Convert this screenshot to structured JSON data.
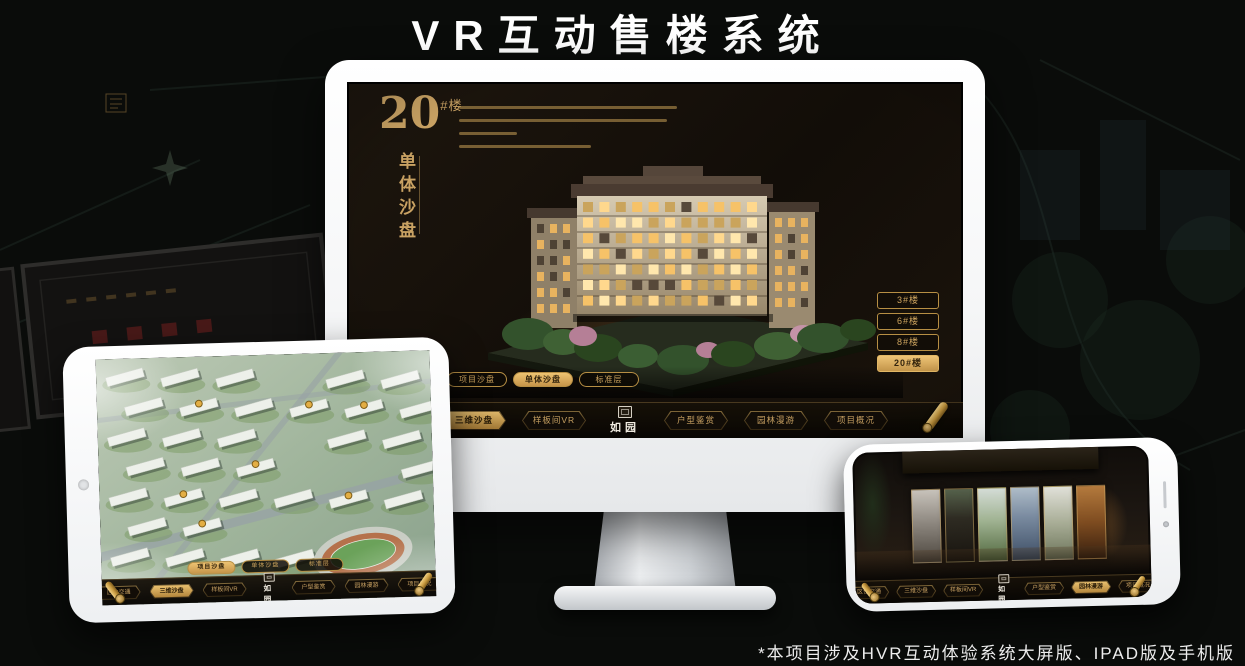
{
  "page": {
    "title": "VR互动售楼系统",
    "footer_note": "*本项目涉及HVR互动体验系统大屏版、IPAD版及手机版"
  },
  "colors": {
    "gold": "#c9a263",
    "gold_bright": "#e8bf6e",
    "screen_bg": "#17110c",
    "active_text": "#2a1d08",
    "monitor_frame": "#f5f6f7"
  },
  "desktop_app": {
    "heading": {
      "number": "20",
      "suffix": "#楼",
      "subtitle": "单体沙盘"
    },
    "building_buttons": {
      "items": [
        "3#楼",
        "6#楼",
        "8#楼",
        "20#楼"
      ],
      "active": "20#楼"
    },
    "sub_tabs": {
      "items": [
        "项目沙盘",
        "单体沙盘",
        "标准层"
      ],
      "active": "单体沙盘"
    },
    "nav": {
      "items": [
        "区位交通",
        "三维沙盘",
        "样板间VR",
        "户型鉴赏",
        "园林漫游",
        "项目概况"
      ],
      "active": "三维沙盘",
      "logo": "如园"
    }
  },
  "ipad_app": {
    "sub_tabs": {
      "items": [
        "项目沙盘",
        "单体沙盘",
        "标准层"
      ],
      "active": "项目沙盘"
    },
    "nav": {
      "items": [
        "区位交通",
        "三维沙盘",
        "样板间VR",
        "户型鉴赏",
        "园林漫游",
        "项目概况"
      ],
      "active": "三维沙盘",
      "logo": "如园"
    }
  },
  "phone_app": {
    "nav": {
      "items": [
        "区位交通",
        "三维沙盘",
        "样板间VR",
        "户型鉴赏",
        "园林漫游",
        "项目概况"
      ],
      "active": "园林漫游",
      "logo": "如园"
    }
  }
}
